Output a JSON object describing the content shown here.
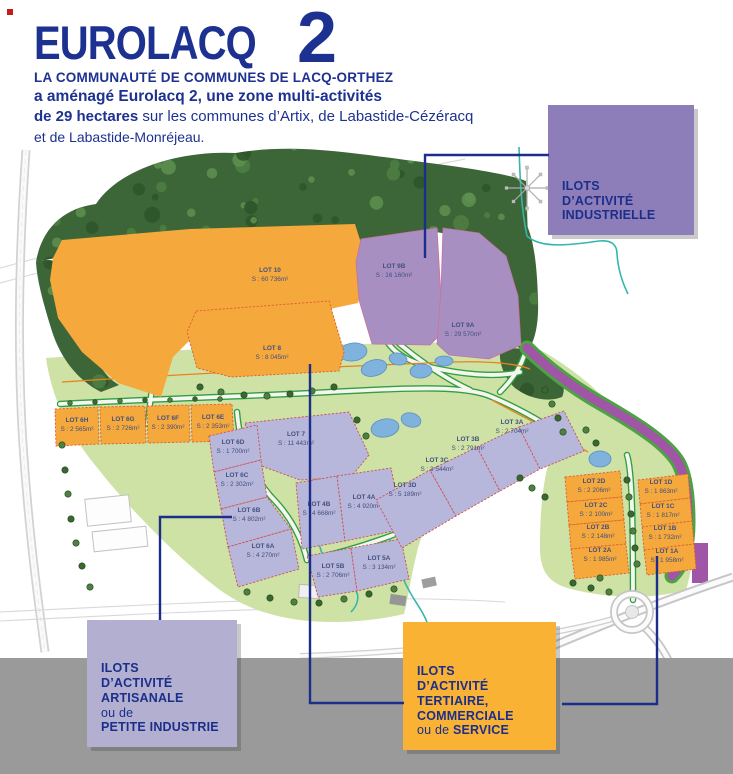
{
  "header": {
    "logo": "EUROLACQ",
    "logo_number": "2",
    "subtitle": "LA COMMUNAUTÉ DE COMMUNES DE LACQ-ORTHEZ",
    "intro_bold": "a aménagé Eurolacq 2, une zone multi-activités",
    "intro_bold2": "de 29 hectares",
    "intro_rest": " sur les communes d’Artix, de Labastide-Cézéracq",
    "intro_line3": "et de Labastide-Monréjeau."
  },
  "legend": {
    "industrielle": {
      "lines": [
        "ILOTS",
        "D’ACTIVITÉ",
        "INDUSTRIELLE"
      ],
      "color": "#8D7DB8"
    },
    "artisanale": {
      "lines": [
        "ILOTS",
        "D’ACTIVITÉ",
        "ARTISANALE",
        "ou de",
        "PETITE INDUSTRIE"
      ],
      "color": "#B2AFD0"
    },
    "tertiaire": {
      "lines": [
        "ILOTS",
        "D’ACTIVITÉ",
        "TERTIAIRE,",
        "COMMERCIALE",
        "ou de SERVICE"
      ],
      "color": "#F9B233"
    }
  },
  "map": {
    "category_colors": {
      "tertiaire": "#F5A83C",
      "industrielle": "#A78FC2",
      "artisanale": "#B7B6DB"
    },
    "lots": [
      {
        "name": "LOT 10",
        "area": "S : 60 736m²",
        "category": "tertiaire"
      },
      {
        "name": "LOT 9B",
        "area": "S : 16 160m²",
        "category": "industrielle"
      },
      {
        "name": "LOT 9A",
        "area": "S : 29 570m²",
        "category": "industrielle"
      },
      {
        "name": "LOT 8",
        "area": "S : 8 045m²",
        "category": "tertiaire"
      },
      {
        "name": "LOT 7",
        "area": "S : 11 443m²",
        "category": "artisanale"
      },
      {
        "name": "LOT 6H",
        "area": "S : 2 565m²",
        "category": "tertiaire"
      },
      {
        "name": "LOT 6G",
        "area": "S : 2 726m²",
        "category": "tertiaire"
      },
      {
        "name": "LOT 6F",
        "area": "S : 2 390m²",
        "category": "tertiaire"
      },
      {
        "name": "LOT 6E",
        "area": "S : 2 353m²",
        "category": "tertiaire"
      },
      {
        "name": "LOT 6D",
        "area": "S : 1 700m²",
        "category": "artisanale"
      },
      {
        "name": "LOT 6C",
        "area": "S : 2 302m²",
        "category": "artisanale"
      },
      {
        "name": "LOT 6B",
        "area": "S : 4 802m²",
        "category": "artisanale"
      },
      {
        "name": "LOT 6A",
        "area": "S : 4 270m²",
        "category": "artisanale"
      },
      {
        "name": "LOT 4B",
        "area": "S : 4 668m²",
        "category": "artisanale"
      },
      {
        "name": "LOT 4A",
        "area": "S : 4 920m²",
        "category": "artisanale"
      },
      {
        "name": "LOT 5B",
        "area": "S : 2 706m²",
        "category": "artisanale"
      },
      {
        "name": "LOT 5A",
        "area": "S : 3 134m²",
        "category": "artisanale"
      },
      {
        "name": "LOT 3D",
        "area": "S : 5 189m²",
        "category": "artisanale"
      },
      {
        "name": "LOT 3C",
        "area": "S : 3 544m²",
        "category": "artisanale"
      },
      {
        "name": "LOT 3B",
        "area": "S : 2 791m²",
        "category": "artisanale"
      },
      {
        "name": "LOT 3A",
        "area": "S : 2 704m²",
        "category": "artisanale"
      },
      {
        "name": "LOT 2D",
        "area": "S : 2 206m²",
        "category": "tertiaire"
      },
      {
        "name": "LOT 2C",
        "area": "S : 2 100m²",
        "category": "tertiaire"
      },
      {
        "name": "LOT 2B",
        "area": "S : 2 148m²",
        "category": "tertiaire"
      },
      {
        "name": "LOT 2A",
        "area": "S : 1 985m²",
        "category": "tertiaire"
      },
      {
        "name": "LOT 1D",
        "area": "S : 1 863m²",
        "category": "tertiaire"
      },
      {
        "name": "LOT 1C",
        "area": "S : 1 817m²",
        "category": "tertiaire"
      },
      {
        "name": "LOT 1B",
        "area": "S : 1 732m²",
        "category": "tertiaire"
      },
      {
        "name": "LOT 1A",
        "area": "S : 1 958m²",
        "category": "tertiaire"
      }
    ]
  }
}
